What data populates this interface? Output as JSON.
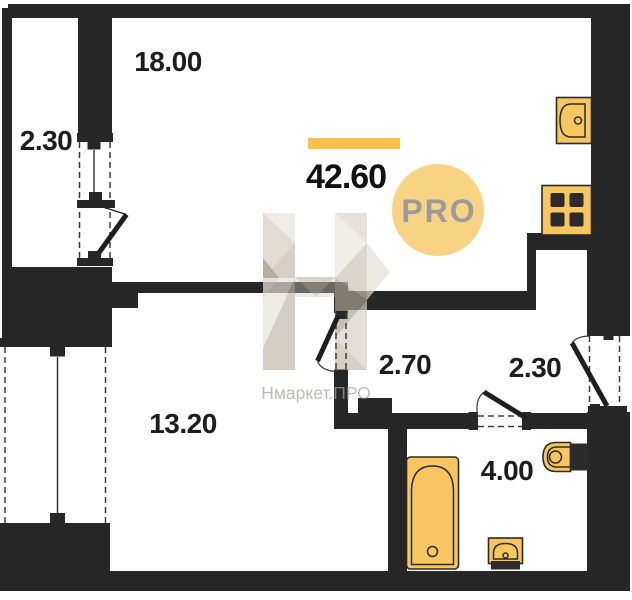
{
  "plan": {
    "total_area": "42.60",
    "badge_label": "PRO",
    "watermark_text": "Нмаркет.ПРО",
    "labels": {
      "living_kitchen": "18.00",
      "balcony": "2.30",
      "room": "13.20",
      "hallway": "2.70",
      "entry_hall": "2.30",
      "bathroom": "4.00"
    },
    "colors": {
      "wall": "#272727",
      "fixture_fill": "#F8C660",
      "accent_bar": "#F7C14B",
      "badge_bg": "#F9D384",
      "badge_text": "#9B9B9B",
      "label_text": "#1D1D1D",
      "watermark_text": "#A5A29F"
    },
    "fixtures": [
      "kitchen-sink",
      "stove",
      "toilet",
      "bathtub",
      "washbasin"
    ]
  }
}
